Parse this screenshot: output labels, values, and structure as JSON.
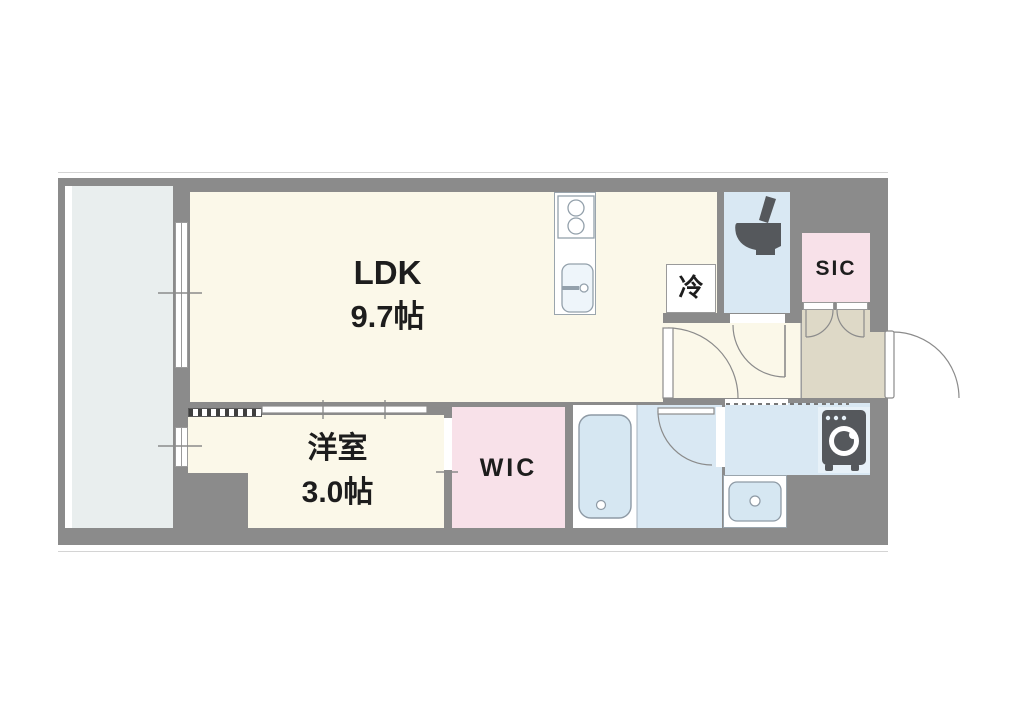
{
  "plan": {
    "type": "apartment-floor-plan",
    "rooms": {
      "ldk": {
        "label": "LDK",
        "size": "9.7帖"
      },
      "western_room": {
        "label": "洋室",
        "size": "3.0帖"
      },
      "wic": {
        "label": "WIC"
      },
      "sic": {
        "label": "SIC"
      },
      "refrigerator": {
        "label": "冷"
      }
    },
    "fixtures": [
      "kitchen-stove",
      "kitchen-sink",
      "refrigerator-space",
      "toilet",
      "bathtub",
      "washbasin",
      "washing-machine",
      "entrance-door",
      "sliding-partition",
      "balcony"
    ],
    "colors": {
      "wall": "#8b8b8b",
      "room": "#fbf8e9",
      "wet_area": "#d9e8f3",
      "closet_pink": "#f8e1e9",
      "entrance_beige": "#ded9c7",
      "balcony": "#e9eeee",
      "appliance_dark": "#55585c"
    }
  }
}
